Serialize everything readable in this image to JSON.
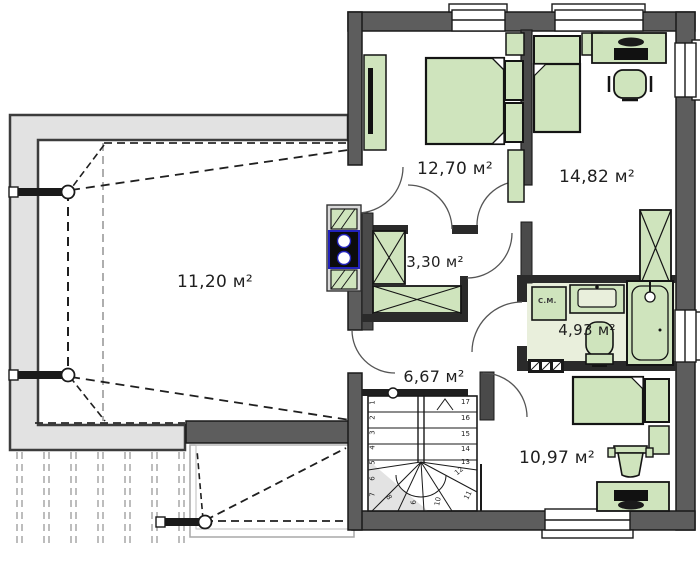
{
  "plan": {
    "type": "floor-plan",
    "units": "м²",
    "rooms": [
      {
        "id": "terrace",
        "area_label": "11,20 м²"
      },
      {
        "id": "bedroom",
        "area_label": "12,70 м²"
      },
      {
        "id": "room-right",
        "area_label": "14,82 м²"
      },
      {
        "id": "closet",
        "area_label": "3,30 м²"
      },
      {
        "id": "bathroom",
        "area_label": "4,93 м²"
      },
      {
        "id": "hall",
        "area_label": "6,67 м²"
      },
      {
        "id": "room-bottom",
        "area_label": "10,97 м²"
      }
    ],
    "bathroom": {
      "washing_machine_label": "С.М."
    },
    "stairs": {
      "straight_numbers": [
        "17",
        "16",
        "15",
        "14",
        "13"
      ],
      "winder_numbers": [
        "12",
        "11",
        "10",
        "9",
        "8"
      ],
      "left_numbers": [
        "1",
        "2",
        "3",
        "4",
        "5",
        "6",
        "7"
      ]
    },
    "colors": {
      "exterior_wall": "#5d5d5d",
      "interior_wall": "#4a4a4a",
      "line": "#1a1a1a",
      "furniture_fill": "#cfe4bd",
      "terrace_roof": "#e2e2e2",
      "bath_floor": "#e9efdc",
      "chimney_accent": "#2222bb",
      "pergola_dash": "#bdbdbd"
    }
  }
}
